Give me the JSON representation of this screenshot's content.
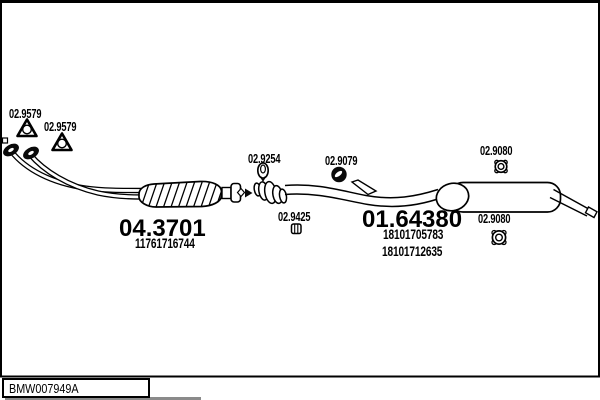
{
  "diagram": {
    "callouts": {
      "front_gasket_1": "02.9579",
      "front_gasket_2": "02.9579",
      "seal_ring": "02.9254",
      "rubber_mount": "02.9079",
      "clamp": "02.9425",
      "grommet_top": "02.9080",
      "grommet_bottom": "02.9080"
    },
    "parts": {
      "catalytic_converter": {
        "code": "04.3701",
        "oem": "11761716744"
      },
      "rear_muffler": {
        "code": "01.64380",
        "oem_1": "18101705783",
        "oem_2": "18101712635"
      }
    }
  },
  "footer": {
    "drawing_id": "BMW007949A"
  },
  "colors": {
    "line": "#000000",
    "background": "#ffffff",
    "shadow": "#8a8a8a"
  }
}
